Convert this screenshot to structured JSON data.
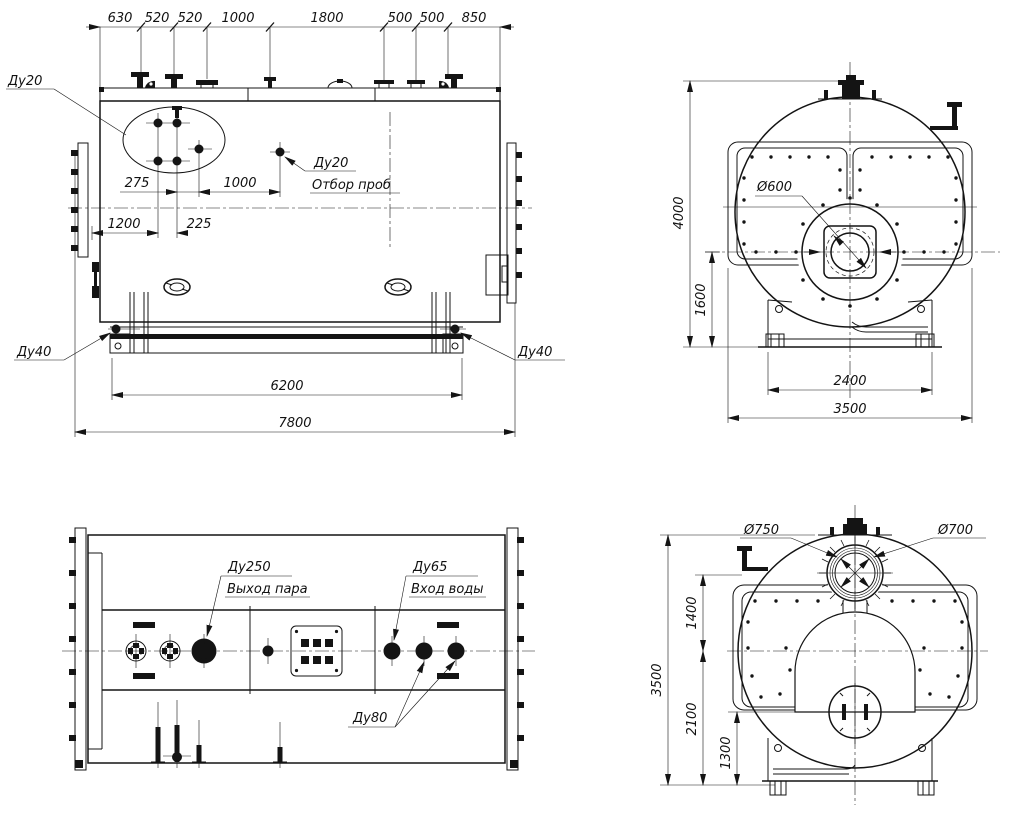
{
  "drawing": {
    "title": "Steam boiler general arrangement drawing",
    "line_color": "#141414",
    "bg_color": "#ffffff",
    "views": {
      "side": {
        "top_chain": [
          "630",
          "520",
          "520",
          "1000",
          "1800",
          "500",
          "500",
          "850"
        ],
        "dim_275": "275",
        "dim_1000": "1000",
        "dim_1200": "1200",
        "dim_225": "225",
        "dim_6200": "6200",
        "dim_7800": "7800",
        "label_du20": "Ду20",
        "label_du20_sample": "Ду20",
        "label_sample": "Отбор проб",
        "label_du40_left": "Ду40",
        "label_du40_right": "Ду40"
      },
      "front": {
        "dim_4000": "4000",
        "dim_1600": "1600",
        "dim_2400": "2400",
        "dim_3500": "3500",
        "label_d600": "Ø600"
      },
      "plan": {
        "label_du250": "Ду250",
        "label_steam_out": "Выход пара",
        "label_du65": "Ду65",
        "label_water_in": "Вход воды",
        "label_du80": "Ду80"
      },
      "rear": {
        "label_d750": "Ø750",
        "label_d700": "Ø700",
        "dim_1400": "1400",
        "dim_3500": "3500",
        "dim_2100": "2100",
        "dim_1300": "1300"
      }
    }
  }
}
